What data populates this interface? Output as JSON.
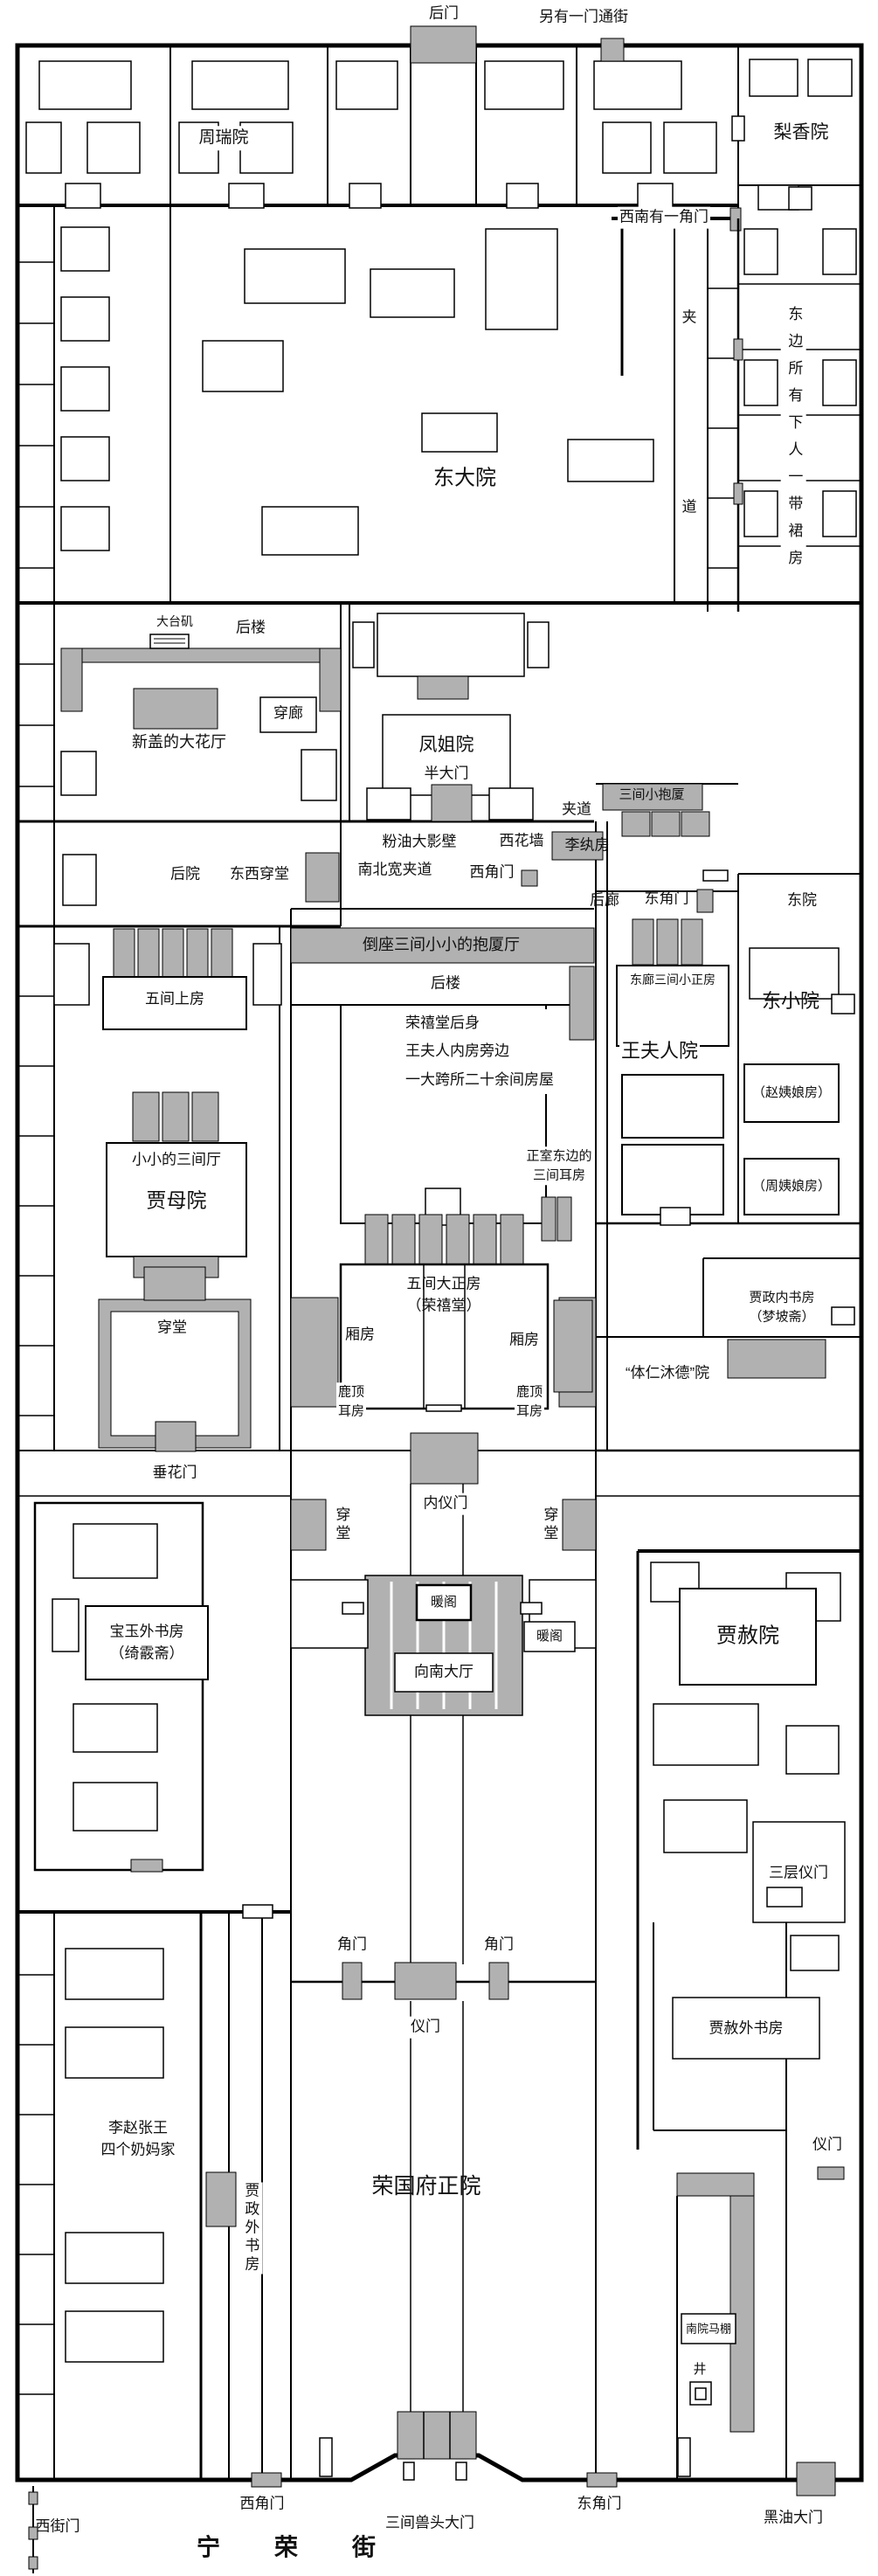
{
  "colors": {
    "wall": "#000000",
    "block": "#b1b1b1",
    "background": "#ffffff"
  },
  "labels": {
    "houmen": "后门",
    "lingyoumen": "另有一门通街",
    "zhouruiyuan": "周瑞院",
    "lixiangyuan": "梨香院",
    "xinanjiaomen": "西南有一角门",
    "dongdayuan": "东大院",
    "jiadao_top": "夹",
    "jiadao_bottom": "道",
    "dongbianxiaren": "东边所有下人一带裙房",
    "dataiji": "大台矶",
    "houlou_1": "后楼",
    "chuanlang": "穿廊",
    "xingaihuating": "新盖的大花厅",
    "fengjieyuan": "凤姐院",
    "bandamen": "半大门",
    "sanjianxiaobaosha": "三间小抱厦",
    "jiadao_2": "夹道",
    "liwanfang": "李纨房",
    "fenyoudayingbi": "粉油大影壁",
    "xihuaqiang": "西花墙",
    "nanbeikuanjiadao": "南北宽夹道",
    "xijiaomen_1": "西角门",
    "houyuan": "后院",
    "dongxichuantang": "东西穿堂",
    "houlang": "后廊",
    "dongjiaomen_1": "东角门",
    "dongyuan": "东院",
    "daozuobaoshating": "倒座三间小小的抱厦厅",
    "houlou_2": "后楼",
    "donglangsanjian": "东廊三间小正房",
    "dongxiaoyuan": "东小院",
    "wujianshangfang": "五间上房",
    "rongxitanghoushen": "荣禧堂后身\n王夫人内房旁边\n一大跨所二十余间房屋",
    "wangfurenyuan": "王夫人院",
    "zhaoyiniangfang": "（赵姨娘房）",
    "xiaoxiaosanjianting": "小小的三间厅",
    "zhengshierfang": "正室东边的\n三间耳房",
    "zhouyiniangfang": "（周姨娘房）",
    "jiamuyuan": "贾母院",
    "wujiandazhengfang": "五间大正房\n（荣禧堂）",
    "jiazhengneishufang": "贾政内书房\n（梦坡斋）",
    "xiangfang_l": "厢房",
    "xiangfang_r": "厢房",
    "tirenmudeyuan": "“体仁沐德”院",
    "chuantang_1": "穿堂",
    "ludingerfang_l": "鹿顶\n耳房",
    "ludingerfang_r": "鹿顶\n耳房",
    "chuihuamen": "垂花门",
    "neiyimen": "内仪门",
    "chuantang_2": "穿堂",
    "chuantang_3": "穿堂",
    "nuange_1": "暖阁",
    "nuange_2": "暖阁",
    "xiangnandating": "向南大厅",
    "baoyuwaishufang": "宝玉外书房\n（绮霰斋）",
    "jiasheyuan": "贾赦院",
    "sancengyimen": "三层仪门",
    "jiaomen_l": "角门",
    "jiaomen_r": "角门",
    "yimen_1": "仪门",
    "jiashewaishufang": "贾赦外书房",
    "yimen_2": "仪门",
    "naimajia": "李赵张王\n四个奶妈家",
    "jiazhengwaishufang": "贾政外书房",
    "rongguofuzhengyuan": "荣国府正院",
    "nanyuanmapeng": "南院马棚",
    "jing": "井",
    "xijiaomen_2": "西角门",
    "sanjianshoutoudamen": "三间兽头大门",
    "dongjiaomen_2": "东角门",
    "heiyoudamen": "黑油大门",
    "xijiemen": "西街门",
    "ningrongjie": "宁荣街"
  }
}
